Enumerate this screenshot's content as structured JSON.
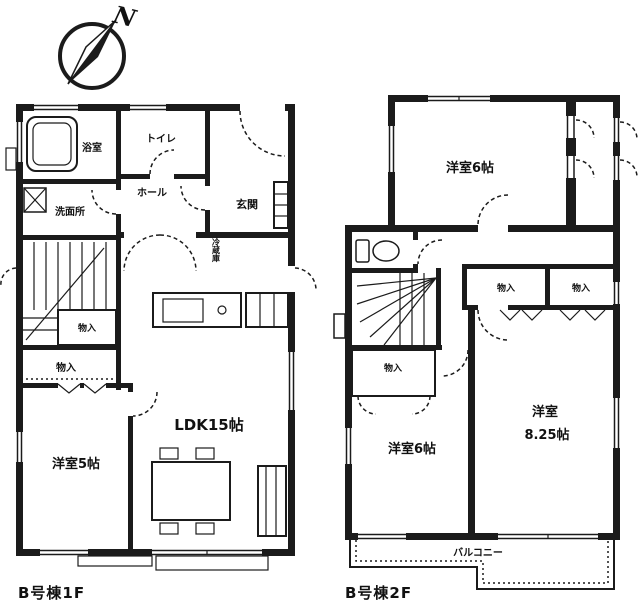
{
  "colors": {
    "ink": "#1b1b1b",
    "paper": "#ffffff"
  },
  "compass": {
    "north_label": "N"
  },
  "floor1": {
    "caption": "B号棟1F",
    "labels": {
      "bath": "浴室",
      "washroom": "洗面所",
      "toilet": "トイレ",
      "hall": "ホール",
      "entrance": "玄関",
      "closet_under_stairs": "物入",
      "closet_west": "物入",
      "refrigerator": "冷蔵庫",
      "ldk": "LDK15帖",
      "bedroom": "洋室5帖"
    }
  },
  "floor2": {
    "caption": "B号棟2F",
    "labels": {
      "bedroom_north": "洋室6帖",
      "closet_west": "物入",
      "closet_center": "物入",
      "closet_east": "物入",
      "bedroom_west": "洋室6帖",
      "bedroom_east_line1": "洋室",
      "bedroom_east_line2": "8.25帖",
      "balcony": "バルコニー"
    }
  }
}
